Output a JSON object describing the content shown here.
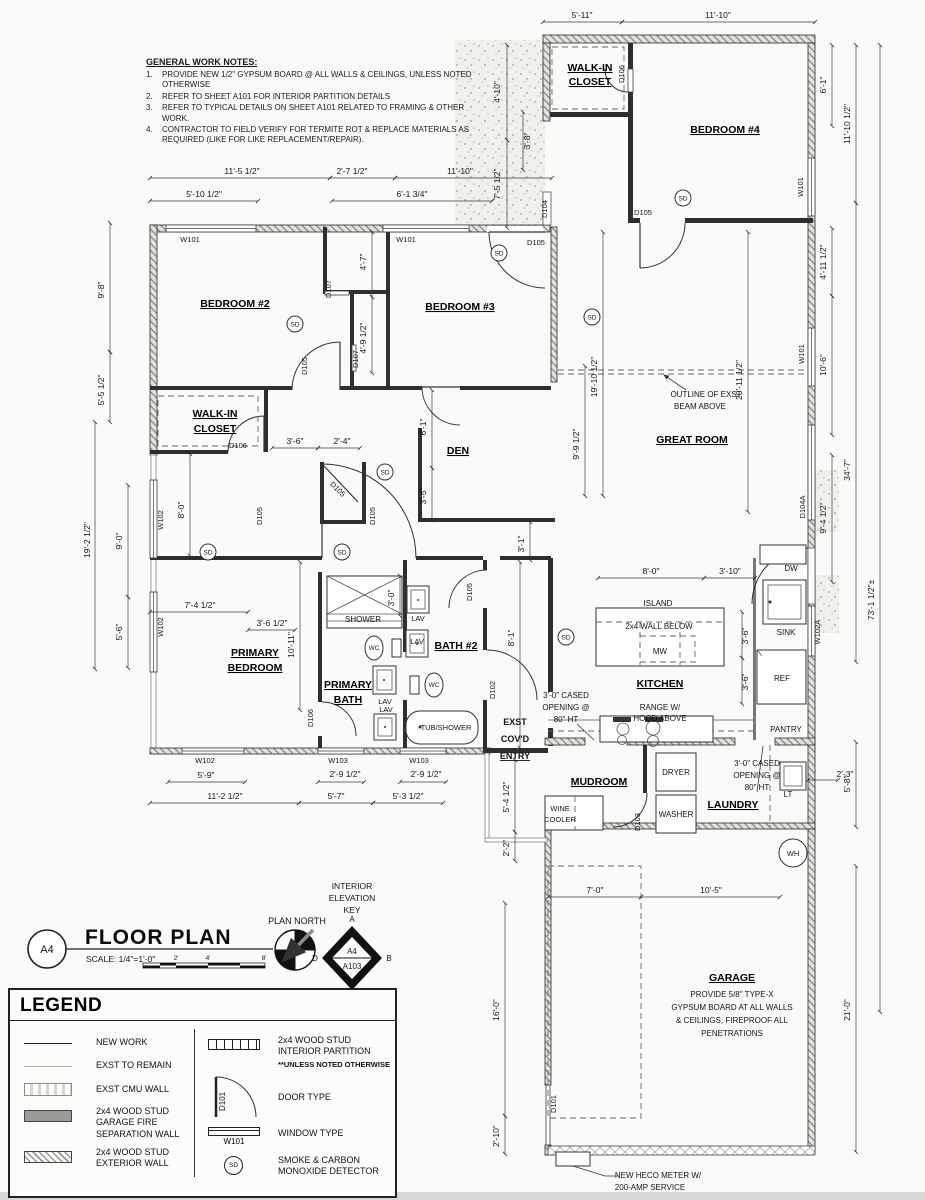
{
  "notes": {
    "title": "GENERAL WORK NOTES:",
    "nums": [
      "1.",
      "2.",
      "3.",
      "4."
    ],
    "items": [
      "PROVIDE NEW 1/2\" GYPSUM BOARD @ ALL WALLS & CEILINGS, UNLESS NOTED OTHERWISE",
      "REFER TO SHEET A101 FOR INTERIOR PARTITION DETAILS",
      "REFER TO TYPICAL DETAILS ON SHEET A101 RELATED TO FRAMING & OTHER WORK.",
      "CONTRACTOR TO FIELD VERIFY FOR TERMITE ROT & REPLACE MATERIALS AS REQUIRED (LIKE FOR LIKE REPLACEMENT/REPAIR)."
    ]
  },
  "rooms": {
    "bedroom2": "BEDROOM #2",
    "bedroom3": "BEDROOM #3",
    "bedroom4": "BEDROOM #4",
    "walkin1": "WALK-IN",
    "walkin2": "CLOSET",
    "den": "DEN",
    "great": "GREAT ROOM",
    "primary1": "PRIMARY",
    "primary2": "BEDROOM",
    "pbath1": "PRIMARY",
    "pbath2": "BATH",
    "bath2": "BATH #2",
    "kitchen": "KITCHEN",
    "mudroom": "MUDROOM",
    "laundry": "LAUNDRY",
    "garage": "GARAGE",
    "entry1": "EXST",
    "entry2": "COV'D",
    "entry3": "ENTRY"
  },
  "ann": {
    "beam1": "OUTLINE OF EXST",
    "beam2": "BEAM ABOVE",
    "island": "ISLAND",
    "wallbelow": "2x4 WALL BELOW",
    "mw": "MW",
    "range1": "RANGE W/",
    "range2": "HOOD ABOVE",
    "cased1": "3'-0\" CASED",
    "cased2": "OPENING @",
    "cased3": "80\" HT",
    "shower": "SHOWER",
    "tub": "TUB/SHOWER",
    "wc": "WC",
    "lav": "LAV",
    "dw": "DW",
    "sink": "SINK",
    "ref": "REF",
    "pantry": "PANTRY",
    "lt": "LT",
    "wh": "WH",
    "dryer": "DRYER",
    "washer": "WASHER",
    "wine1": "WINE",
    "wine2": "COOLER",
    "g1": "PROVIDE 5/8\" TYPE-X",
    "g2": "GYPSUM BOARD AT ALL WALLS",
    "g3": "& CEILINGS, FIREPROOF ALL",
    "g4": "PENETRATIONS",
    "heco1": "NEW HECO METER W/",
    "heco2": "200-AMP SERVICE"
  },
  "tags": {
    "sd": "SD",
    "w101": "W101",
    "w102": "W102",
    "w102a": "W102A",
    "w103": "W103",
    "d101": "D101",
    "d102": "D102",
    "d103": "D103",
    "d104": "D104",
    "d104a": "D104A",
    "d105": "D105",
    "d106": "D106",
    "d107": "D107"
  },
  "dims": {
    "t1": "5'-11\"",
    "t2": "11'-10\"",
    "t3": "11'-5 1/2\"",
    "t4": "2'-7 1/2\"",
    "t5": "11'-10\"",
    "t6": "5'-10 1/2\"",
    "t7": "6'-1 3/4\"",
    "l1": "9'-8\"",
    "l2": "5'-5 1/2\"",
    "l3": "19'-2 1/2\"",
    "l4": "9'-0\"",
    "l5": "5'-6\"",
    "l6": "4'-10\"",
    "l7": "7'-5 1/2\"",
    "l8": "3'-8\"",
    "r1": "6'-1\"",
    "r2": "11'-10 1/2\"",
    "r3": "4'-11 1/2\"",
    "r4": "10'-6\"",
    "r5": "34'-7\"",
    "r6": "9'-4 1/2\"",
    "r7": "73'-1 1/2\"±",
    "r8": "2'-3\"",
    "r9": "5'-8\"",
    "r10": "21'-0\"",
    "i1": "4'-7\"",
    "i2": "4'-9 1/2\"",
    "i3": "19'-10 1/2\"",
    "i4": "9'-9 1/2\"",
    "i5": "20'-11 1/2\"",
    "i6": "3'-6\"",
    "i7": "2'-4\"",
    "i8": "6'-1\"",
    "i9": "3'-5\"",
    "i10": "8'-0\"",
    "i11": "3'-1\"",
    "i12": "8'-1\"",
    "i13": "7'-4 1/2\"",
    "i14": "3'-6 1/2\"",
    "i15": "10'-11\"",
    "i16": "3'-0\"",
    "i17": "8'-0\"",
    "i18": "3'-10\"",
    "i19": "3'-6\"",
    "i20": "3'-6\"",
    "b1": "5'-9\"",
    "b2": "11'-2 1/2\"",
    "b3": "2'-9 1/2\"",
    "b4": "5'-7\"",
    "b5": "2'-9 1/2\"",
    "b6": "5'-3 1/2\"",
    "b7": "5'-4 1/2\"",
    "b8": "2'-2\"",
    "b9": "7'-0\"",
    "b10": "10'-5\"",
    "b11": "16'-0\"",
    "b12": "2'-10\""
  },
  "title_block": {
    "sheet": "A4",
    "title": "FLOOR PLAN",
    "scale": "SCALE: 1/4\"=1'-0\"",
    "ticks": [
      "2'",
      "4'",
      "8'"
    ],
    "north": "PLAN NORTH"
  },
  "elev_key": {
    "l1": "INTERIOR",
    "l2": "ELEVATION",
    "l3": "KEY",
    "top": "A4",
    "bot": "A103",
    "a": "A",
    "b": "B",
    "c": "C",
    "d": "D"
  },
  "legend": {
    "title": "LEGEND",
    "items_left": [
      {
        "label": "NEW WORK"
      },
      {
        "label": "EXST TO REMAIN"
      },
      {
        "label": "EXST CMU WALL"
      },
      {
        "label": "2x4 WOOD STUD GARAGE FIRE SEPARATION WALL"
      },
      {
        "label": "2x4 WOOD STUD EXTERIOR WALL"
      }
    ],
    "items_right": [
      {
        "label": "2x4 WOOD STUD INTERIOR PARTITION",
        "note": "**UNLESS NOTED OTHERWISE"
      },
      {
        "label": "DOOR TYPE",
        "tag": "D101"
      },
      {
        "label": "WINDOW TYPE",
        "tag": "W101"
      },
      {
        "label": "SMOKE & CARBON MONOXIDE DETECTOR",
        "tag": "SD"
      }
    ]
  }
}
